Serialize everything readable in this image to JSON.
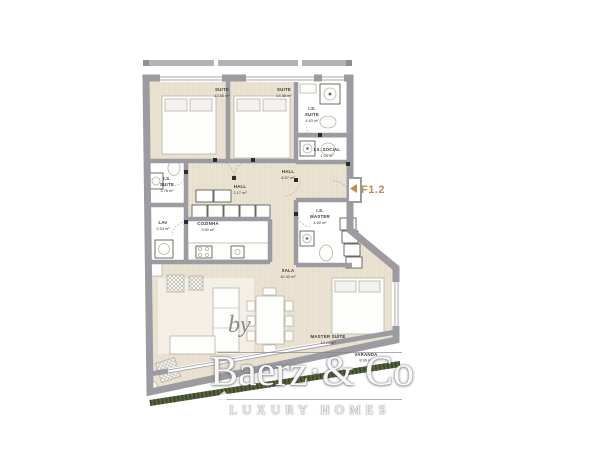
{
  "plan": {
    "unit": {
      "arrow": "◀",
      "label": "F1.2",
      "color": "#c08a52"
    },
    "rooms": [
      {
        "name": "SUITE",
        "area": "13.65 m²"
      },
      {
        "name": "SUITE",
        "area": "14.38 m²"
      },
      {
        "name": "I.S.",
        "name2": "SUITE",
        "area": "4.63 m²"
      },
      {
        "name": "I.S. SOCIAL",
        "area": "1.04 m²"
      },
      {
        "name": "HALL",
        "area": "8.57 m²"
      },
      {
        "name": "HALL",
        "area": "2.17 m²"
      },
      {
        "name": "I.S.",
        "name2": "SUITE",
        "area": "3.76 m²"
      },
      {
        "name": "LAV",
        "area": "2.54 m²"
      },
      {
        "name": "COZINHA",
        "area": "9.50 m²"
      },
      {
        "name": "I.S.",
        "name2": "MASTER",
        "area": "4.60 m²"
      },
      {
        "name": "SALA",
        "area": "40.32 m²"
      },
      {
        "name": "MASTER SUITE",
        "area": "19.25 m²"
      },
      {
        "name": "VARANDA",
        "area": "8.90 m²"
      }
    ],
    "colors": {
      "wall": "#9b9ba1",
      "floor_wood": "#ebe3d2",
      "floor_wet": "#ffffff",
      "garden_edge": "#4f5c33"
    }
  },
  "watermark": {
    "by": "by",
    "brand": "Baerz·& Co",
    "tagline": "LUXURY HOMES"
  }
}
